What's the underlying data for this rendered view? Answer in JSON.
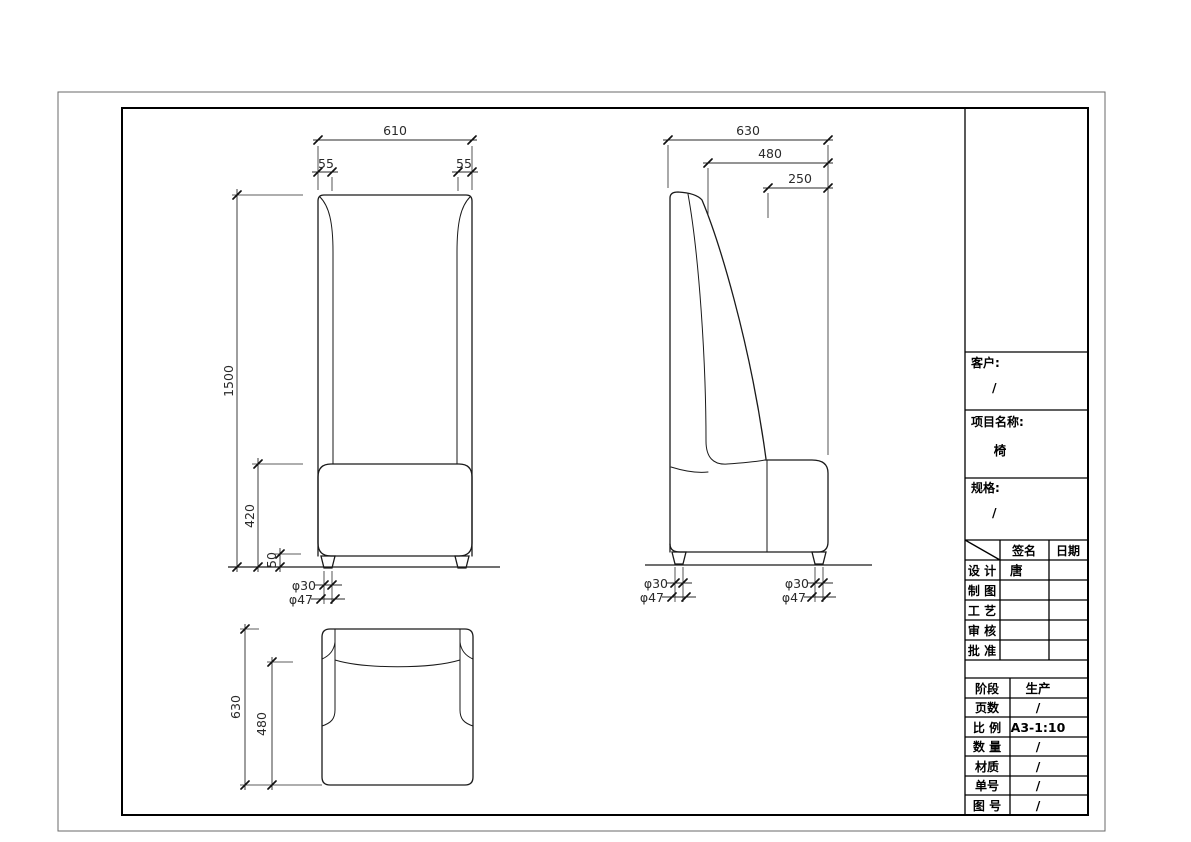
{
  "sheet": {
    "background": "#ffffff",
    "line_color": "#1a1a1a"
  },
  "front_view": {
    "dims": {
      "overall_width": "610",
      "post_width_left": "55",
      "post_width_right": "55",
      "overall_height": "1500",
      "seat_height": "420",
      "leg_height": "50",
      "leg_dia_bottom": "φ30",
      "leg_dia_top": "φ47"
    }
  },
  "side_view": {
    "dims": {
      "overall_depth": "630",
      "seat_depth": "480",
      "backrest_top_offset": "250",
      "rear_leg_dia_bottom": "φ30",
      "rear_leg_dia_top": "φ47",
      "front_leg_dia_bottom": "φ30",
      "front_leg_dia_top": "φ47"
    }
  },
  "top_view": {
    "dims": {
      "overall_depth": "630",
      "seat_depth": "480"
    }
  },
  "title_block": {
    "customer": {
      "label": "客户:",
      "value": "/"
    },
    "project": {
      "label": "项目名称:",
      "value": "椅"
    },
    "spec": {
      "label": "规格:",
      "value": "/"
    },
    "sign_table": {
      "col_sign": "签名",
      "col_date": "日期",
      "rows": [
        {
          "label": "设 计",
          "sign": "唐",
          "date": ""
        },
        {
          "label": "制 图",
          "sign": "",
          "date": ""
        },
        {
          "label": "工 艺",
          "sign": "",
          "date": ""
        },
        {
          "label": "审 核",
          "sign": "",
          "date": ""
        },
        {
          "label": "批 准",
          "sign": "",
          "date": ""
        }
      ]
    },
    "info_table": {
      "rows": [
        {
          "label": "阶段",
          "value": "生产"
        },
        {
          "label": "页数",
          "value": "/"
        },
        {
          "label": "比 例",
          "value": "A3-1:10"
        },
        {
          "label": "数 量",
          "value": "/"
        },
        {
          "label": "材质",
          "value": "/"
        },
        {
          "label": "单号",
          "value": "/"
        },
        {
          "label": "图 号",
          "value": "/"
        }
      ]
    }
  }
}
